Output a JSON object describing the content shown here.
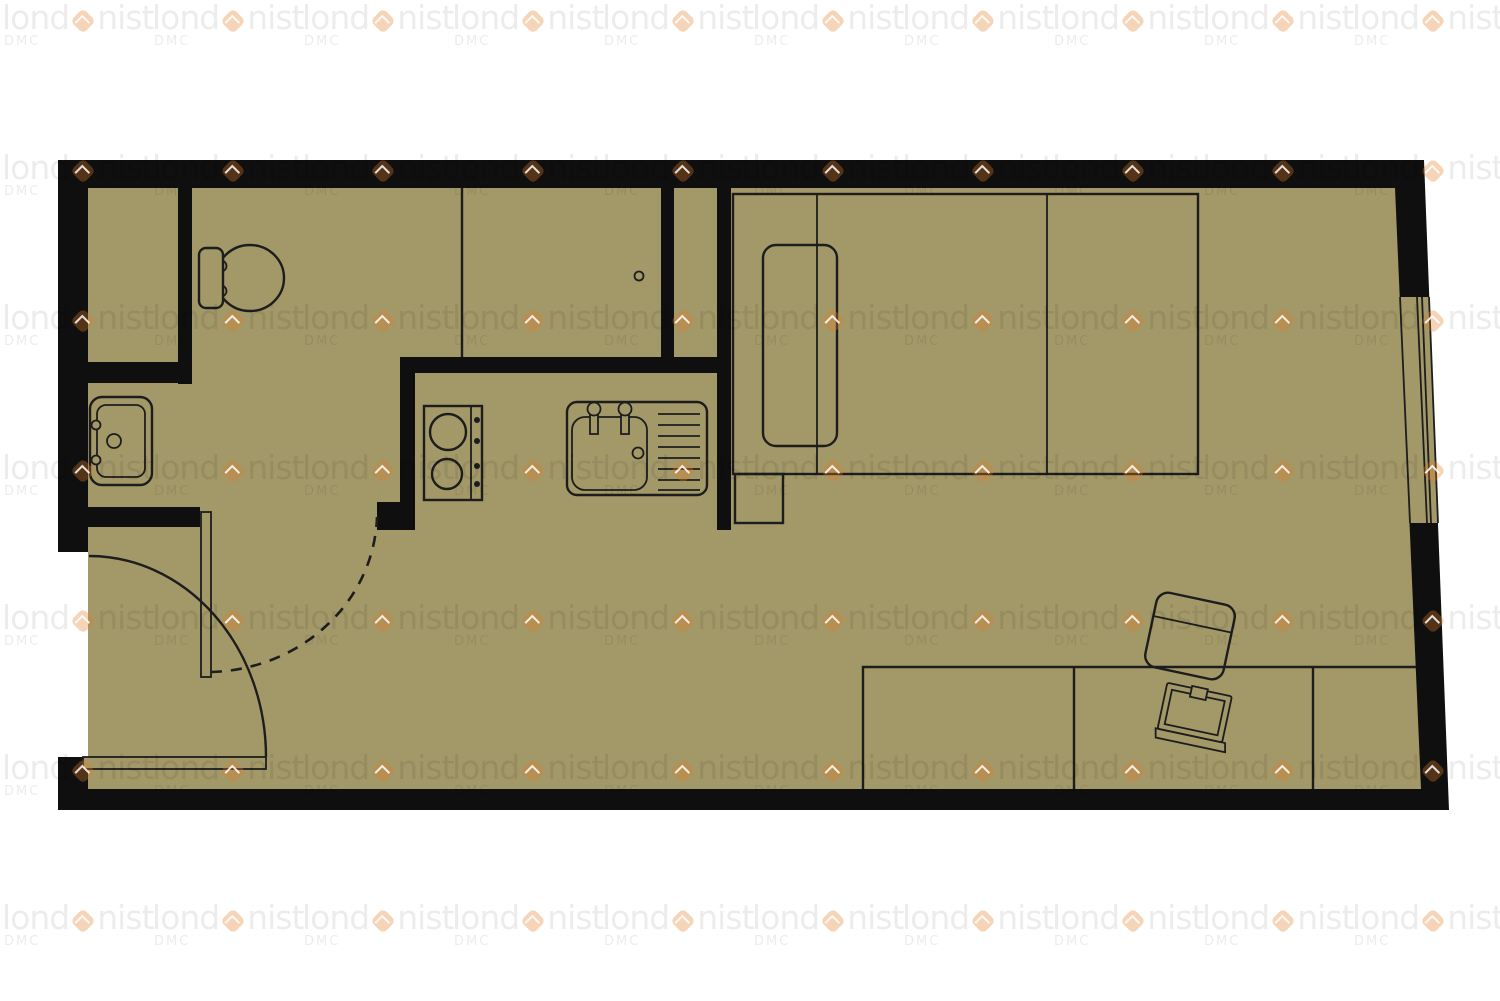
{
  "watermark": {
    "prefix": "lond",
    "suffix": "nist",
    "sub": "DMC"
  },
  "colors": {
    "floor": "#a39868",
    "wall": "#0f0f0f",
    "outline": "#1d1d1d",
    "accent": "rgba(226,125,40,.33)",
    "wmtext": "rgba(0,0,0,.075)",
    "wmsub": "rgba(0,0,0,.08)",
    "page": "#ffffff"
  },
  "watermark_grid": {
    "cols": 10,
    "rows": 7,
    "pitch_x": 150,
    "pitch_y": 150,
    "offset_x": 2,
    "offset_y": 1
  }
}
